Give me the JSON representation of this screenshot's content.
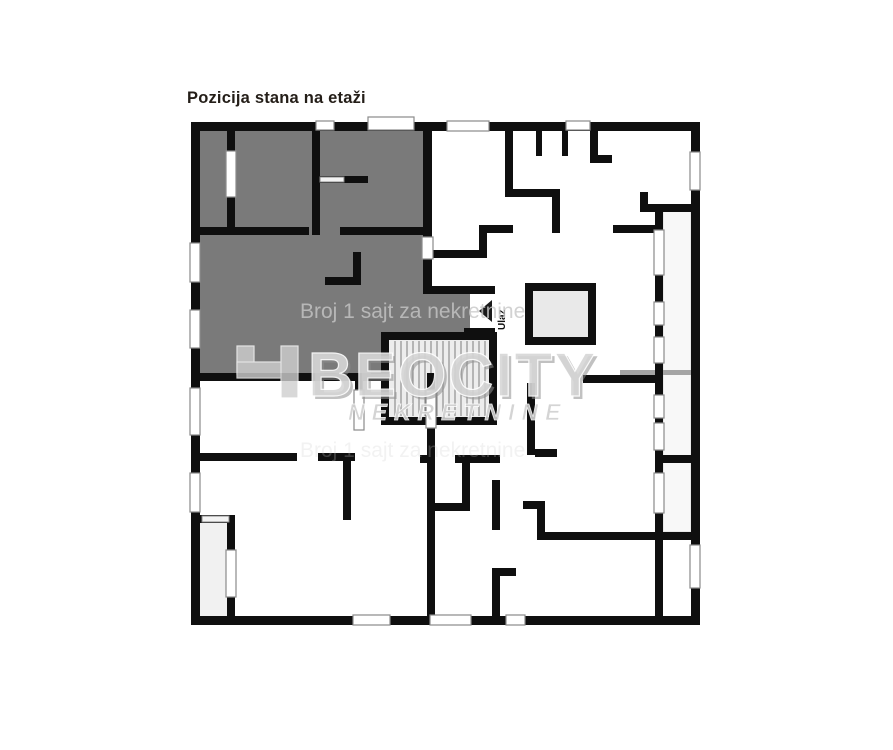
{
  "title": "Pozicija stana na etaži",
  "plan": {
    "entrance_label": "Ulaz",
    "wall_color": "#0f0f0f",
    "highlight_color": "#7a7a7a",
    "stair_fill": "#ededed",
    "elevator_fill": "#e9e9e9",
    "balcony_fill": "#f8f8f8",
    "terrace_fill": "#f1f1f1"
  },
  "watermark": {
    "tagline": "Broj 1 sajt za nekretnine",
    "logo_text": "BEOCITY",
    "logo_subtext": "NEKRETNINE"
  }
}
